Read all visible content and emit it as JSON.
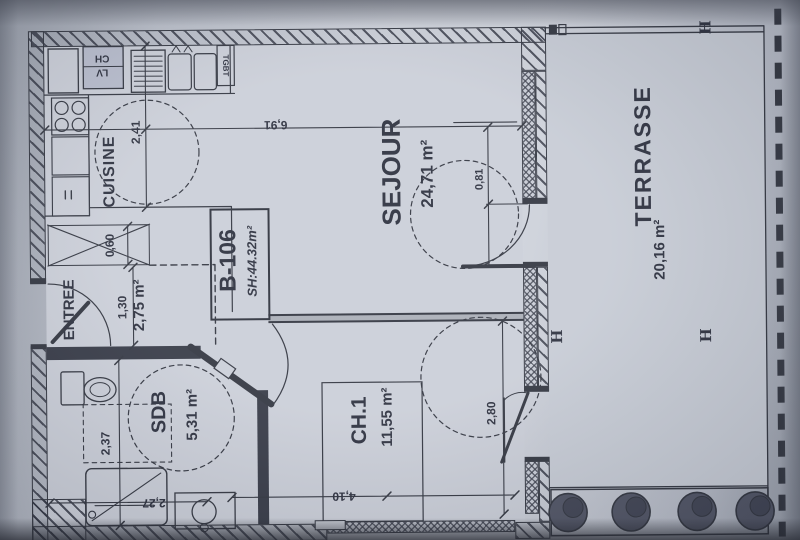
{
  "unit": {
    "id": "B-106",
    "surface_label": "SH:44.32m²"
  },
  "rooms": {
    "cuisine": {
      "name": "CUISINE"
    },
    "sejour": {
      "name": "SEJOUR",
      "area": "24,71 m²"
    },
    "entree": {
      "name": "ENTREE",
      "area": "2,75 m²"
    },
    "sdb": {
      "name": "SDB",
      "area": "5,31 m²"
    },
    "ch1": {
      "name": "CH.1",
      "area": "11,55 m²"
    },
    "terrasse": {
      "name": "TERRASSE",
      "area": "20,16 m²"
    }
  },
  "dimensions": {
    "kitchen_depth": "2,41",
    "living_width": "6,91",
    "door_width": "0,81",
    "closet_depth": "0,60",
    "entry_width": "1,30",
    "sdb_depth": "2,37",
    "sdb_width": "2,27",
    "ch1_width": "4,10",
    "ch1_depth": "2,80"
  },
  "equipment": {
    "tgbt": "TGBT",
    "ch": "CH",
    "lv": "LV"
  },
  "markers": {
    "h1": "H",
    "h2": "H",
    "h3": "H"
  },
  "colors": {
    "ink": "#2b2f3a",
    "paper": "#c9cdd6",
    "wall_fill": "#2f3340"
  }
}
